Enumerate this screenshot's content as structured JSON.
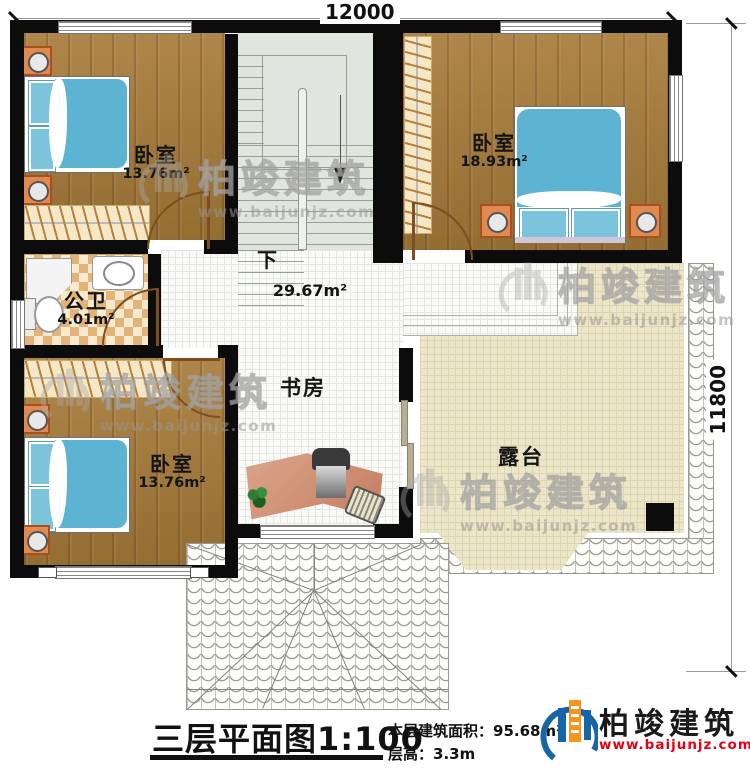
{
  "dimensions": {
    "top": "12000",
    "right": "11800"
  },
  "rooms": {
    "bedroom_top_left": {
      "name": "卧室",
      "area": "13.76m²"
    },
    "bedroom_top_right": {
      "name": "卧室",
      "area": "18.93m²"
    },
    "bathroom": {
      "name": "公卫",
      "area": "4.01m²"
    },
    "hall": {
      "stair_label": "下",
      "area": "29.67m²"
    },
    "study": {
      "name": "书房"
    },
    "bedroom_bottom_left": {
      "name": "卧室",
      "area": "13.76m²"
    },
    "terrace": {
      "name": "露台"
    }
  },
  "footer": {
    "title": "三层平面图",
    "scale": "1:100",
    "area_label": "本层建筑面积：",
    "area_value": "95.68m²",
    "height_label": "层高：",
    "height_value": "3.3m"
  },
  "brand": {
    "name": "柏竣建筑",
    "url": "www.baijunjz.com"
  },
  "watermark": {
    "name": "柏竣建筑",
    "url": "www.baijunjz.com"
  },
  "colors": {
    "wall": "#0c0c0c",
    "wood_floor": "#a87c3a",
    "terrace_floor": "#ece5c8",
    "bed_blue": "#5cb4d2",
    "brand_blue": "#1565a8",
    "brand_orange": "#f7941d",
    "brand_red": "#e60012"
  }
}
